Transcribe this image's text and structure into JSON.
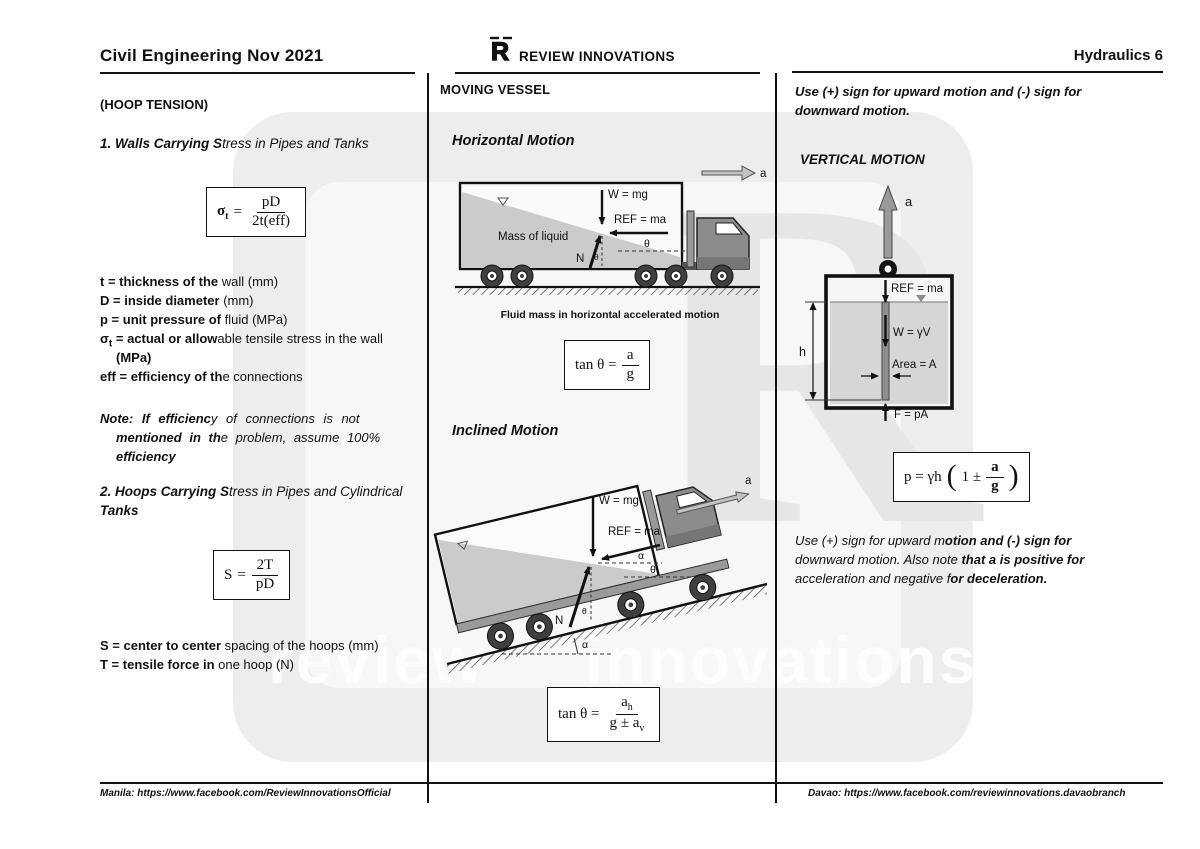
{
  "header": {
    "left_title": "Civil Engineering Nov 2021",
    "brand": "REVIEW INNOVATIONS",
    "brand_logo": "R",
    "right_title": "Hydraulics 6"
  },
  "footer": {
    "left": "Manila: https://www.facebook.com/ReviewInnovationsOfficial",
    "right": "Davao: https://www.facebook.com/reviewinnovations.davaobranch"
  },
  "watermark": {
    "word1": "review",
    "word2": "innovations",
    "logo": "R"
  },
  "left_col": {
    "subtitle": "(HOOP TENSION)",
    "heading1": {
      "b": "1. Walls Carrying S",
      "n": "tress in Pipes and Tanks"
    },
    "formula_sigma": {
      "sigma": "σ",
      "sub": "t",
      "eq": "=",
      "num": "pD",
      "den": "2t(eff)"
    },
    "defs": [
      {
        "b": "t = thickness of the ",
        "n": "wall (mm)"
      },
      {
        "b": "D = inside diameter ",
        "n": "(mm)"
      },
      {
        "b": "p = unit pressure of ",
        "n": "fluid (MPa)"
      }
    ],
    "def_sigma": {
      "sym": "σ",
      "sub": "t",
      "b": " = actual or allow",
      "n": "able tensile stress in the wall",
      "b2": "(MPa)"
    },
    "def_eff": {
      "b": "eff = efficiency of th",
      "n": "e connections"
    },
    "note": [
      {
        "b": "Note: If efficienc",
        "n": "y of connections is not"
      },
      {
        "b": "mentioned in th",
        "n": "e problem, assume 100%"
      },
      {
        "b": "efficiency",
        "n": ""
      }
    ],
    "heading2": {
      "b": "2. Hoops Carrying S",
      "n": "tress in Pipes and Cylindrical"
    },
    "heading2b": "Tanks",
    "formula_s": {
      "lhs": "S",
      "eq": "=",
      "num": "2T",
      "den": "pD"
    },
    "def_s": {
      "b": "S = center to center ",
      "n": "spacing of the hoops (mm)"
    },
    "def_t": {
      "b": "T = tensile force in ",
      "n": "one hoop (N)"
    }
  },
  "center_col": {
    "title": "MOVING VESSEL",
    "horizontal": {
      "title": "Horizontal Motion",
      "labels": {
        "w": "W = mg",
        "ref": "REF = ma",
        "mass": "Mass of liquid",
        "n": "N",
        "theta": "θ",
        "theta_small": "θ",
        "a": "a"
      },
      "caption": "Fluid mass in horizontal accelerated motion",
      "formula": {
        "lhs": "tan θ =",
        "num": "a",
        "den": "g"
      }
    },
    "inclined": {
      "title": "Inclined Motion",
      "labels": {
        "w": "W = mg",
        "ref": "REF = ma",
        "n": "N",
        "theta": "θ",
        "theta_small": "θ",
        "alpha": "α",
        "alpha_base": "α",
        "a": "a"
      },
      "formula": {
        "lhs": "tan θ =",
        "num": "a",
        "num_sub": "h",
        "den": "g ± a",
        "den_sub": "v"
      }
    }
  },
  "right_col": {
    "top_note_line1": "Use (+) sign for upward motion and (-) sign for",
    "top_note_line2": "downward motion.",
    "title": "VERTICAL MOTION",
    "vertical": {
      "labels": {
        "a": "a",
        "ref": "REF = ma",
        "w": "W = γV",
        "area": "Area = A",
        "f": "F = pA",
        "h": "h"
      }
    },
    "formula": {
      "lhs": "p = γh",
      "open": "(",
      "one": "1 ±",
      "num": "a",
      "den": "g",
      "close": ")"
    },
    "bottom_note": [
      {
        "n": "Use (+) sign for upward m",
        "b": "otion and (-) sign for"
      },
      {
        "n": "downward motion. Also note ",
        "b": "that a is positive for"
      },
      {
        "n": "acceleration and negative f",
        "b": "or deceleration."
      }
    ]
  }
}
